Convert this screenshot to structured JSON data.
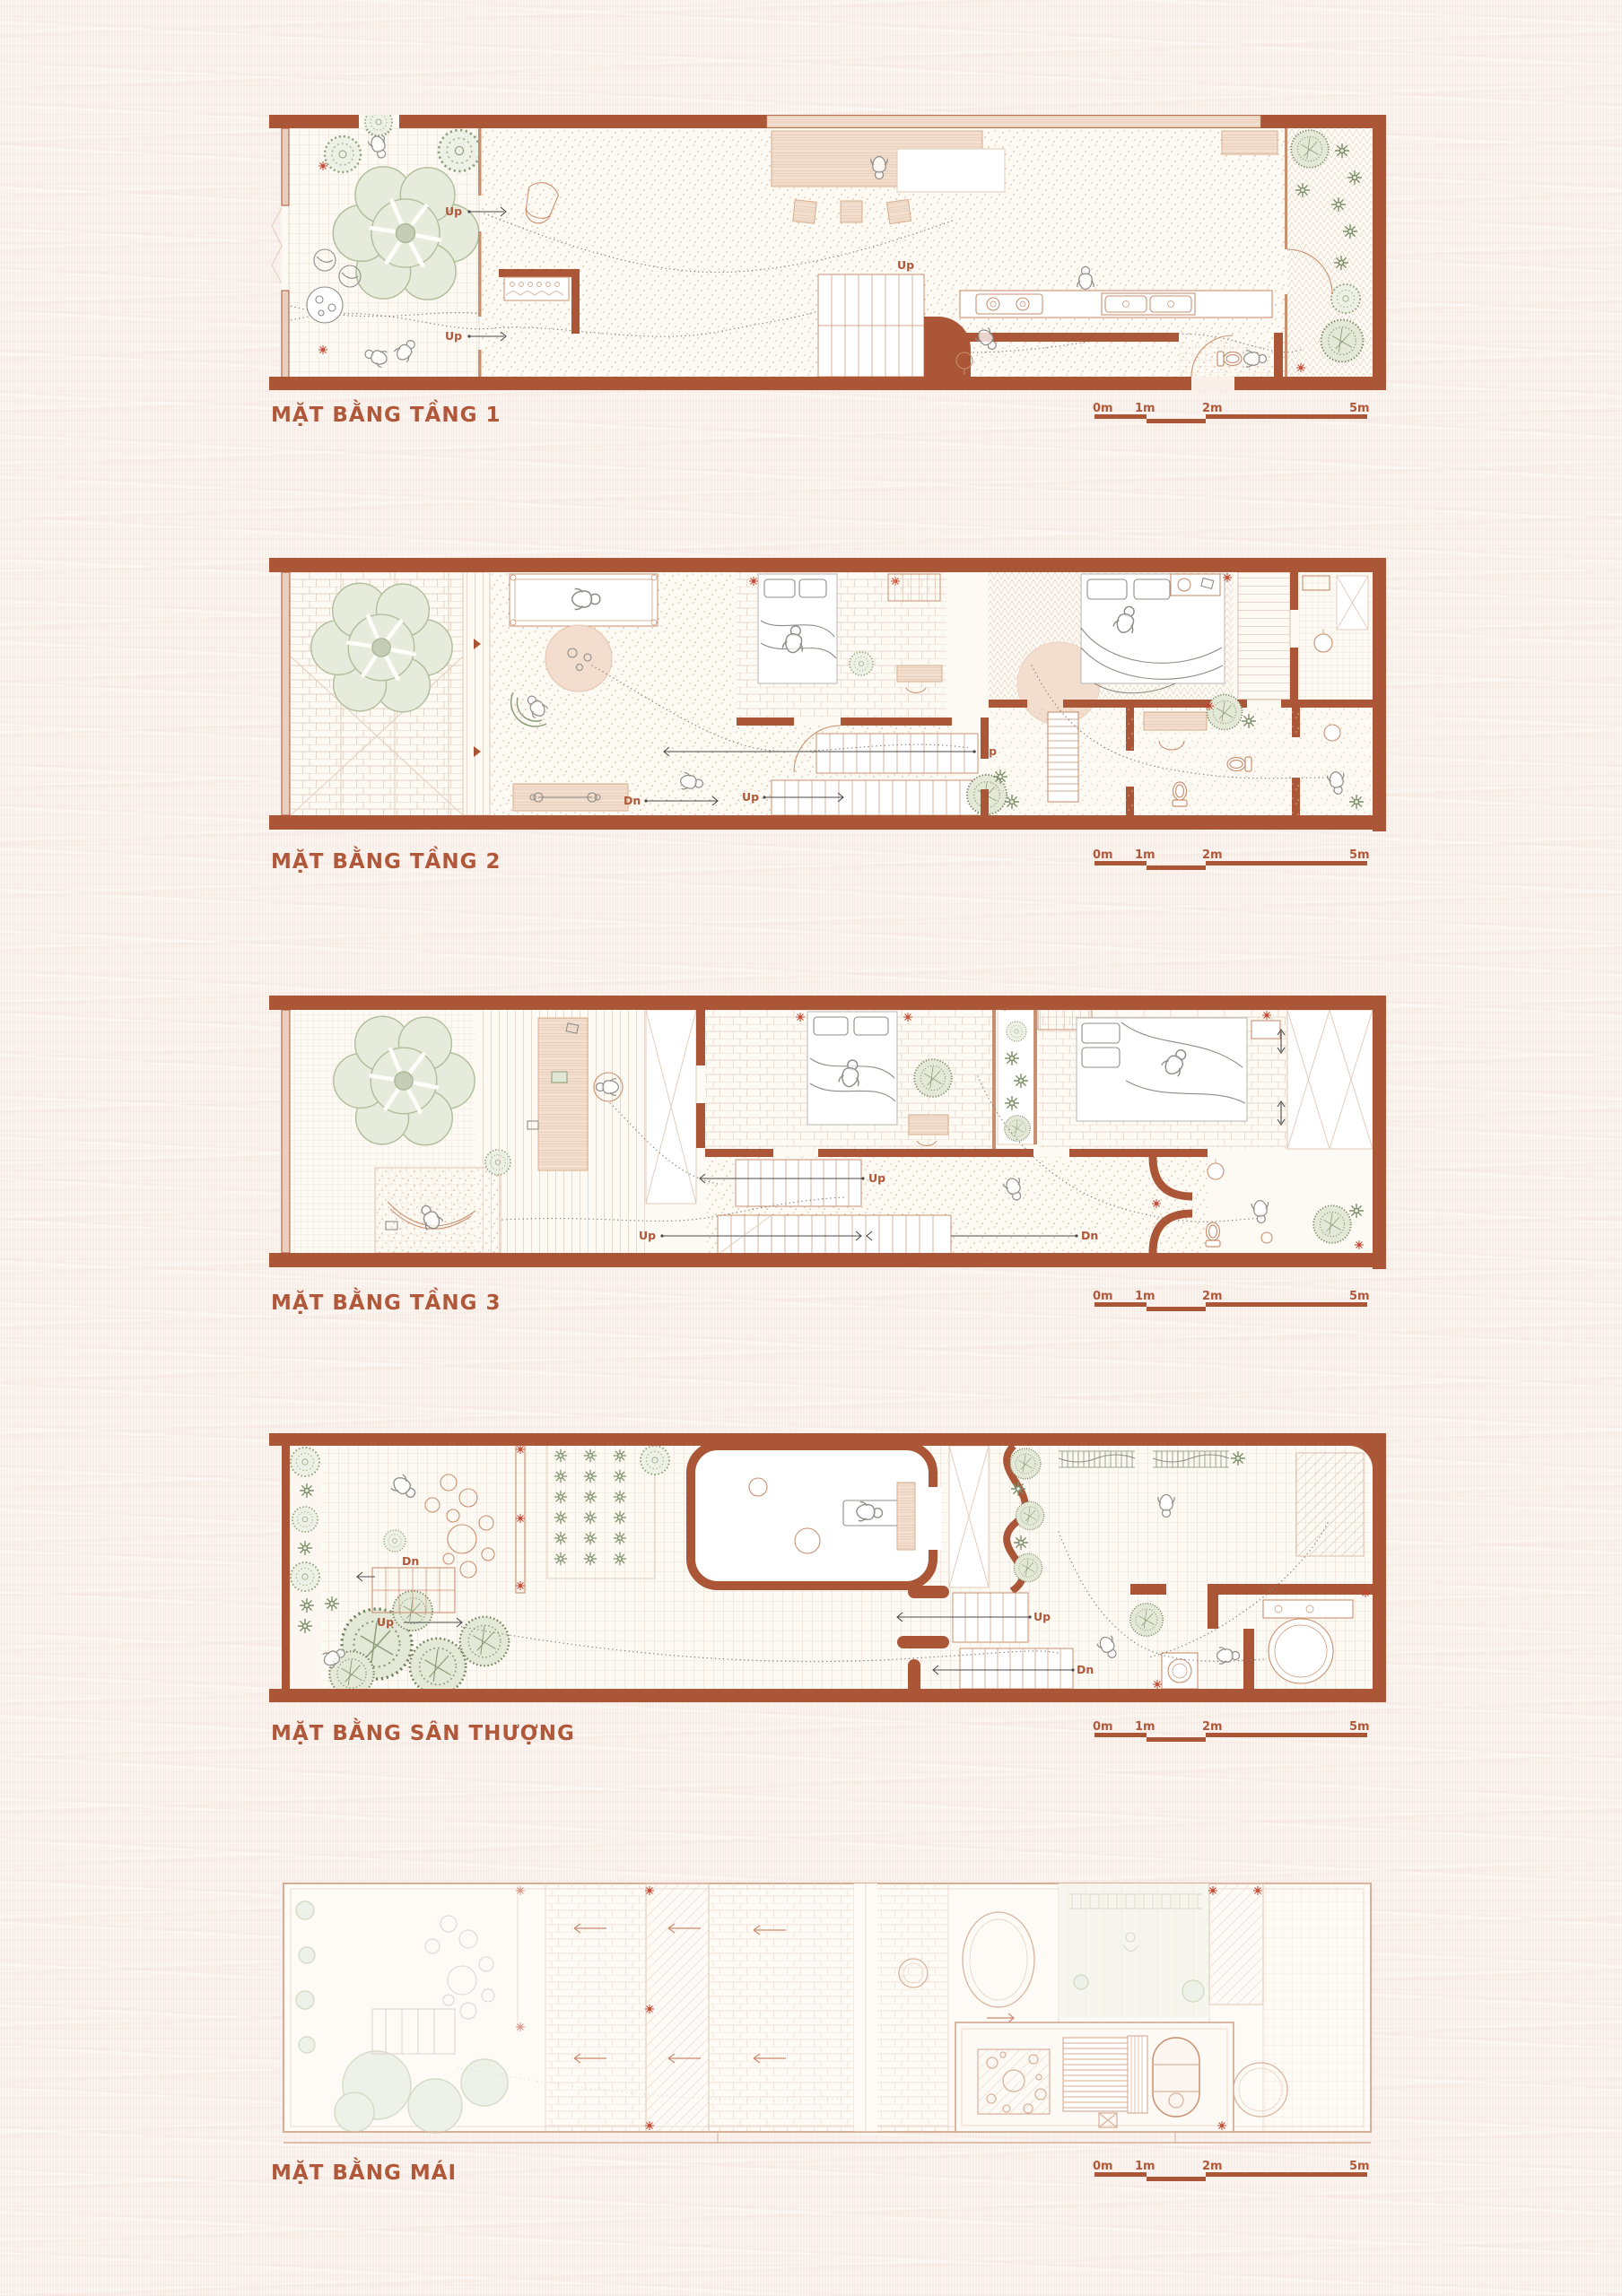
{
  "poster": {
    "plans": [
      {
        "title": "MẶT BẰNG TẦNG 1"
      },
      {
        "title": "MẶT BẰNG TẦNG 2"
      },
      {
        "title": "MẶT BẰNG TẦNG 3"
      },
      {
        "title": "MẶT BẰNG SÂN THƯỢNG"
      },
      {
        "title": "MẶT BẰNG MÁI"
      }
    ],
    "scale_bar": {
      "labels": [
        "0m",
        "1m",
        "2m",
        "5m"
      ]
    },
    "stair_labels": {
      "up": "Up",
      "down": "Dn"
    },
    "colors": {
      "paper": "#f8efe9",
      "wall": "#ac5638",
      "accent_text": "#b2583a",
      "light_line": "#c9906f",
      "foliage_stroke": "#8fa07c",
      "canopy_fill": "#e7ebdb",
      "roof_line": "#d9b49e"
    }
  }
}
